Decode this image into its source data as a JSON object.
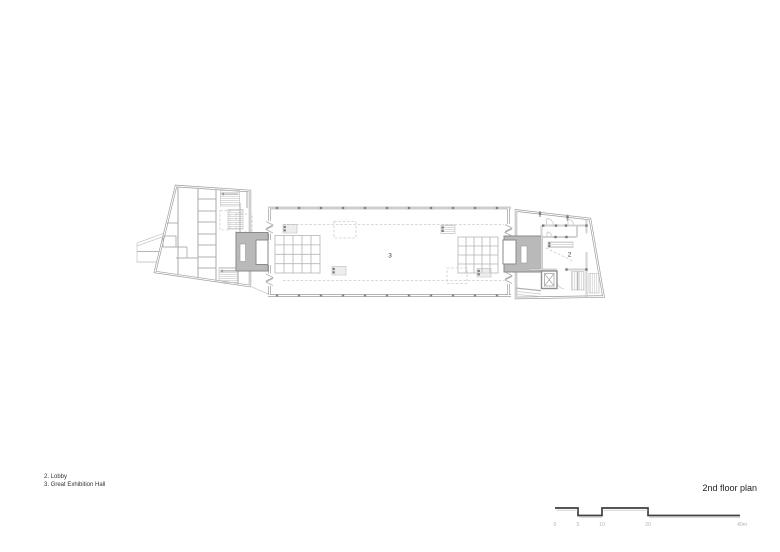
{
  "title": "2nd floor plan",
  "legend": {
    "line1": "2. Lobby",
    "line2": "3. Great Exhibition Hall"
  },
  "plan": {
    "rooms": {
      "lobby": "2",
      "exhibition_hall": "3"
    }
  },
  "scale_bar": {
    "labels": {
      "l0": "0",
      "l5": "5",
      "l10": "10",
      "l20": "20",
      "l40": "40m"
    }
  },
  "colors": {
    "wall": "#9c9c9c",
    "core_fill": "#b9b9b9",
    "core_stroke": "#8a8a8a",
    "scale_bar_dark": "#3f3f3f",
    "scale_bar_echo": "#bdbdbd",
    "scale_label": "#b5b5b5",
    "text": "#333333"
  }
}
